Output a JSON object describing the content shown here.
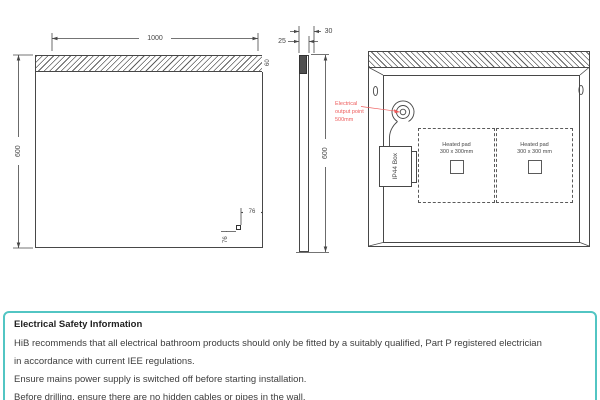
{
  "front_view": {
    "width_dim": "1000",
    "height_dim": "600",
    "light_strip_dim": "60",
    "sensor_offset_h": "76",
    "sensor_offset_v": "76"
  },
  "side_view": {
    "depth_dim": "25",
    "total_depth_dim": "30",
    "height_dim": "600"
  },
  "rear_view": {
    "ip44_box_label": "IP44 Box",
    "electrical_note": {
      "line1": "Electrical",
      "line2": "output point",
      "line3": "500mm"
    },
    "heated_pad_1": {
      "line1": "Heated pad",
      "line2": "300 x 300mm"
    },
    "heated_pad_2": {
      "line1": "Heated pad",
      "line2": "300 x 300 mm"
    }
  },
  "info_panel": {
    "title": "Electrical Safety Information",
    "line1": "HiB recommends that all electrical bathroom products should only be fitted by a suitably qualified, Part P registered electrician",
    "line2": "in accordance with current IEE regulations.",
    "line3": "Ensure mains power supply is switched off before starting installation.",
    "line4": "Before drilling, ensure there are no hidden cables or pipes in the wall."
  },
  "colors": {
    "accent_teal": "#52c5c3",
    "annotation_red": "#ee5c5c",
    "line": "#474747"
  }
}
